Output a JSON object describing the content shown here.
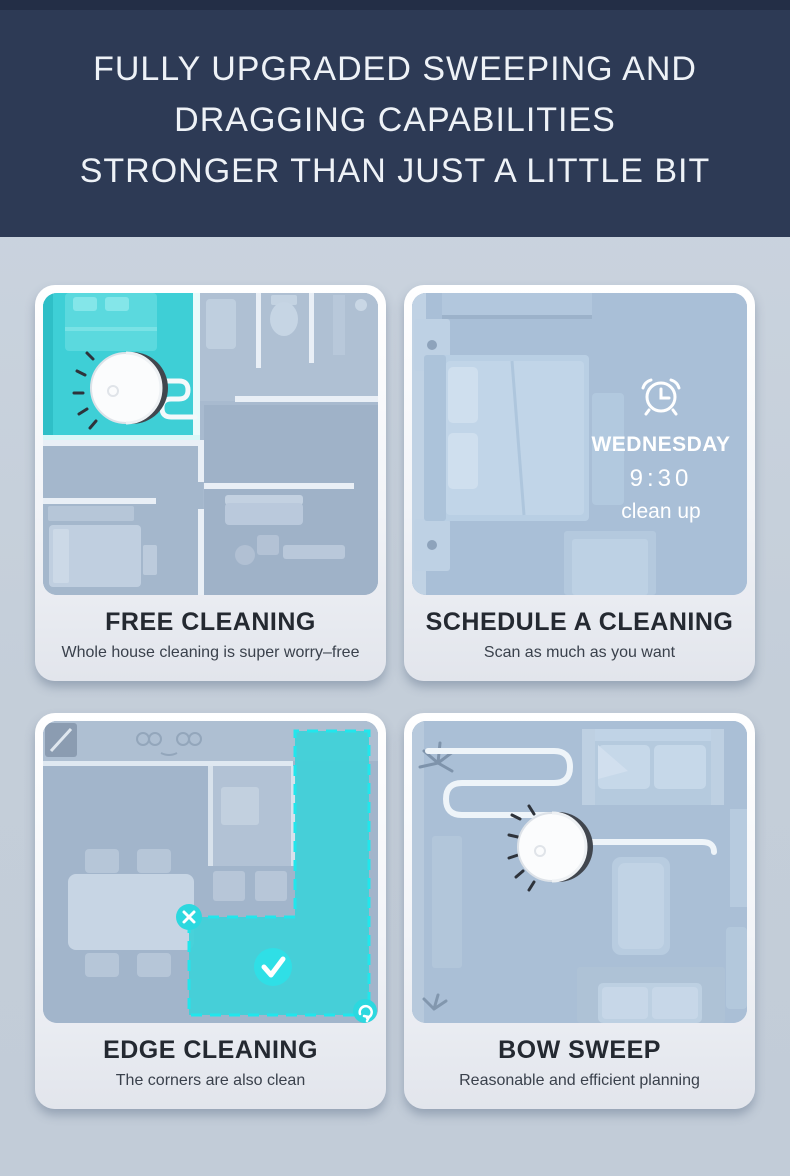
{
  "header": {
    "lines": [
      "FULLY UPGRADED SWEEPING AND",
      "DRAGGING CAPABILITIES",
      "STRONGER THAN JUST A LITTLE BIT"
    ]
  },
  "cards": {
    "free": {
      "title": "FREE CLEANING",
      "subtitle": "Whole house cleaning is super worry–free"
    },
    "schedule": {
      "title": "SCHEDULE A CLEANING",
      "subtitle": "Scan as much as you want",
      "day": "WEDNESDAY",
      "time": "9:30",
      "action": "clean up"
    },
    "edge": {
      "title": "EDGE CLEANING",
      "subtitle": "The corners are also clean"
    },
    "bow": {
      "title": "BOW SWEEP",
      "subtitle": "Reasonable and efficient planning"
    }
  },
  "icons": {
    "alarm_clock": "alarm-clock-icon",
    "check": "checkmark-icon",
    "close": "close-icon",
    "rotate": "rotate-icon",
    "robot": "robot-vacuum"
  },
  "colors": {
    "header_bg": "#2d3a55",
    "header_text": "#eef2f7",
    "page_bg": "#c4ced9",
    "card_bg_top": "#ffffff",
    "card_bg_bottom": "#e2e5ec",
    "floor_blue": "#a8bacf",
    "cyan_accent": "#3ed1d8",
    "cyan_border": "#21e6ec",
    "title_text": "#242931",
    "subtitle_text": "#3a414c",
    "schedule_text": "#ffffff"
  }
}
